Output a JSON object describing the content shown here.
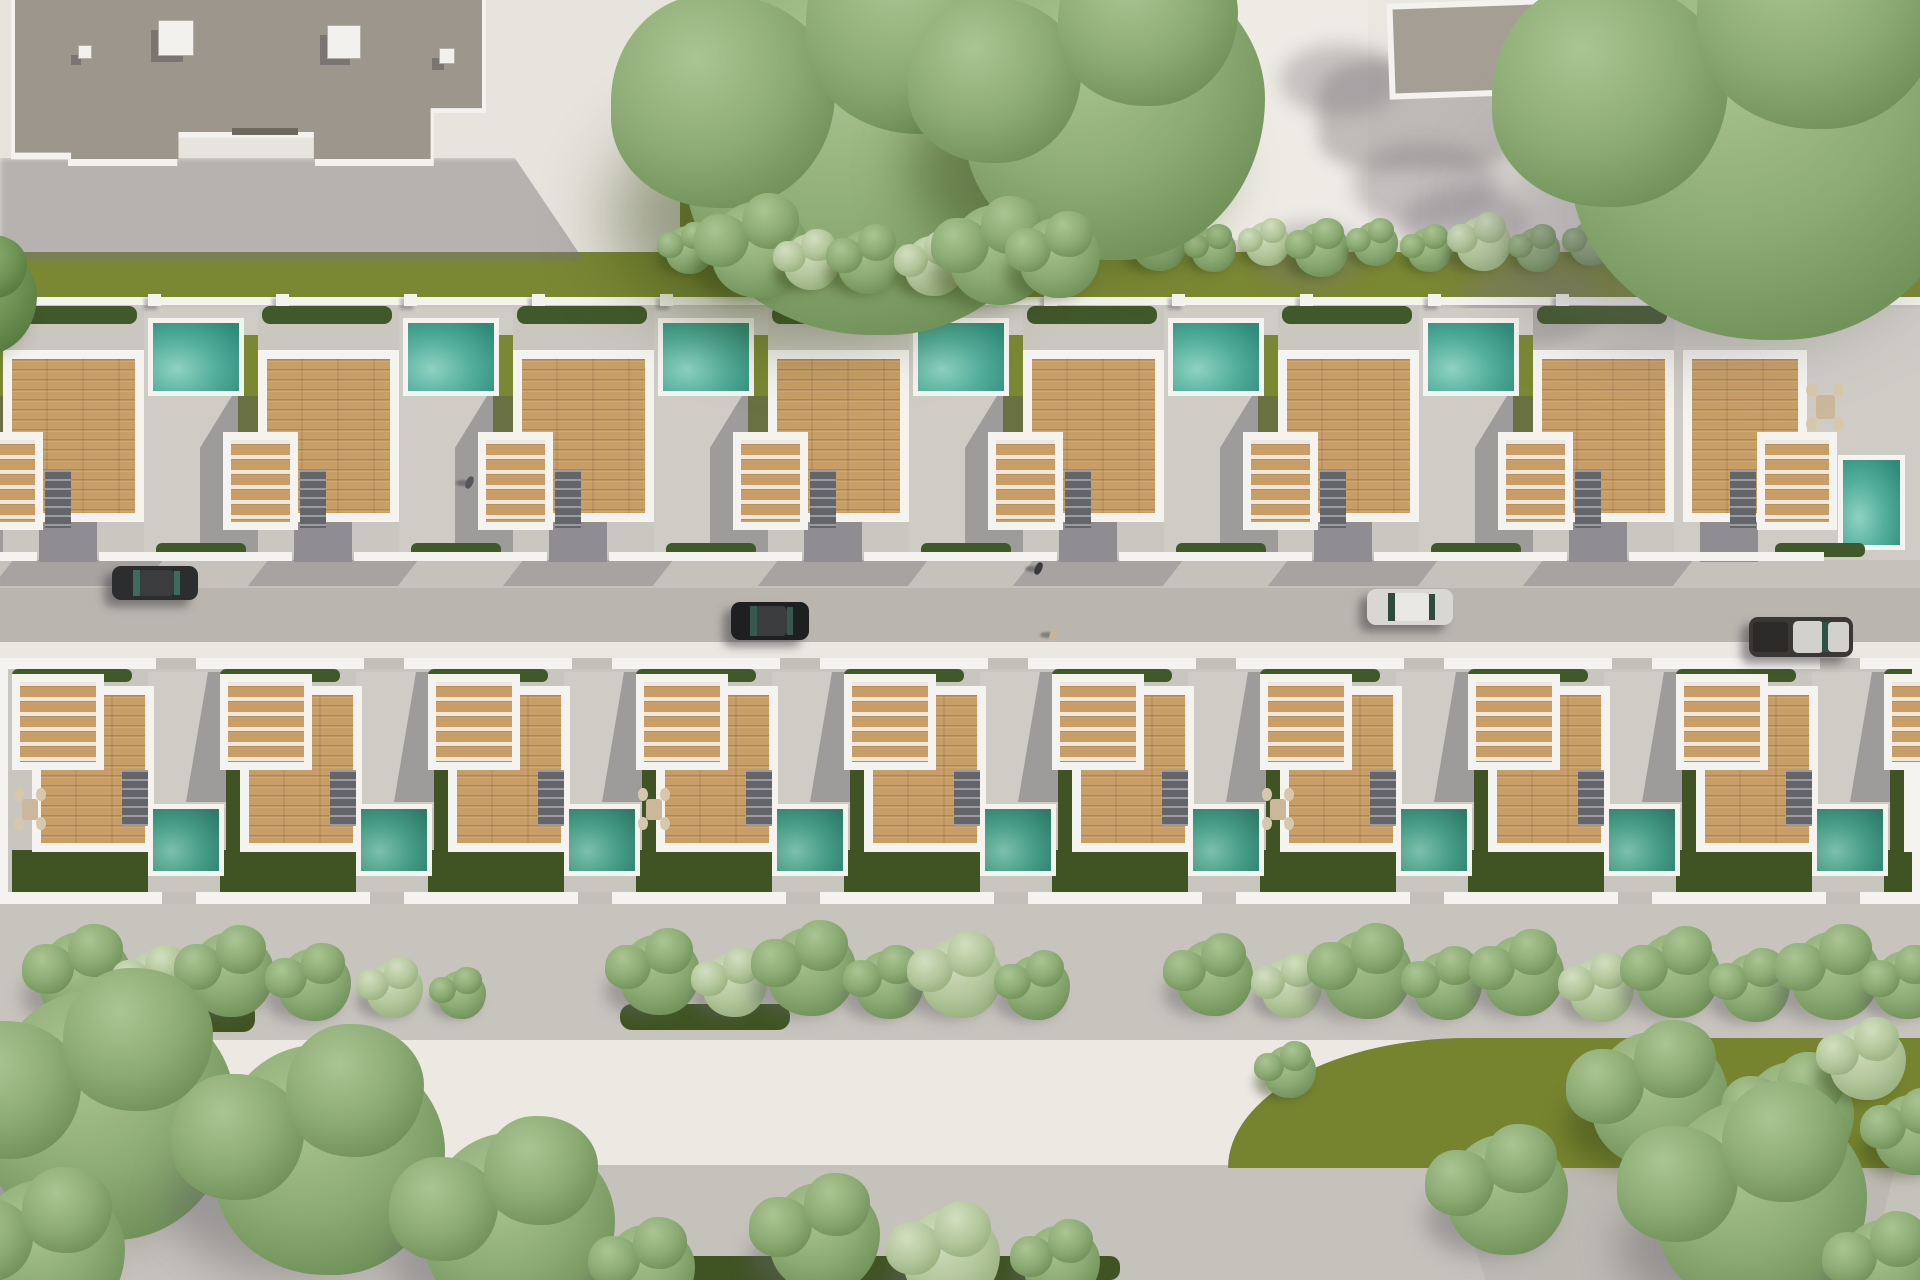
{
  "meta": {
    "scene": "aerial-3d-render-residential-development",
    "summary": {
      "upper_row_villas": 8,
      "lower_row_villas": 9,
      "pools_visible": 16,
      "cars": 4,
      "pedestrians": 3
    }
  },
  "palette": {
    "base": "#d9d5cf",
    "pavement": "#e7e3dd",
    "plaza": "#eae6e0",
    "path": "#eeebe5",
    "roof": "#9d968c",
    "roof_edge": "#f4f2ee",
    "white": "#f5f3ef",
    "grass": "#7a8733",
    "garden": "#3f5422",
    "hedge": "#41582a",
    "concrete": "#cfcbc5",
    "row_base_u": "#cac6c0",
    "row_base_l": "#c9c5bf",
    "sidewalk": "#c6c2bb",
    "asphalt": "#bab6af",
    "curb": "#ebe8e2",
    "promenade": "#c7c3bd",
    "road_white": "#ece9e3",
    "bottom_pav": "#c5c1bb",
    "road_gray": "#bcb8b2",
    "wood": "#c89e66",
    "stair": "#64656b",
    "drive": "#8f8d91",
    "pool_upper": [
      "#8fd2c2",
      "#53ae9c",
      "#2f8a79"
    ],
    "pool_lower": [
      "#7cc0ab",
      "#489e88",
      "#2e7b68"
    ],
    "tones": {
      "sage": [
        "#aac592",
        "#8cab74",
        "#5d7f46"
      ],
      "pale": [
        "#d2dfc0",
        "#b4c79c",
        "#86a06b"
      ],
      "dark": [
        "#8fb273",
        "#6f9455",
        "#47682f"
      ]
    },
    "shadow_ground": "rgba(122,117,121,0.45)",
    "shadow_grass": "rgba(55,70,25,0.45)",
    "shadow_build": "rgba(80,80,88,0.38)"
  },
  "bands": [
    {
      "n": "pavement-top-left",
      "x": 0,
      "y": 0,
      "w": 735,
      "h": 262,
      "c": "#e7e3dd"
    },
    {
      "n": "grass-top-mid",
      "x": 680,
      "y": 0,
      "w": 520,
      "h": 262,
      "c": "#7a8733"
    },
    {
      "n": "path-top",
      "x": 1196,
      "y": 0,
      "w": 176,
      "h": 240,
      "c": "#eeebe5"
    },
    {
      "n": "plaza-top-right",
      "x": 1368,
      "y": 0,
      "w": 552,
      "h": 240,
      "c": "#eae6e0"
    },
    {
      "n": "grass-band",
      "x": 0,
      "y": 252,
      "w": 1920,
      "h": 56,
      "c": "#7a8733"
    },
    {
      "n": "upper-row-ground",
      "x": 0,
      "y": 305,
      "w": 1920,
      "h": 255,
      "c": "#cac6c0"
    },
    {
      "n": "sidewalk-upper",
      "x": 0,
      "y": 556,
      "w": 1920,
      "h": 36,
      "c": "#c6c2bb"
    },
    {
      "n": "street-asphalt",
      "x": 0,
      "y": 588,
      "w": 1920,
      "h": 56,
      "c": "#bab6af"
    },
    {
      "n": "street-curb",
      "x": 0,
      "y": 642,
      "w": 1920,
      "h": 16,
      "c": "#ebe8e2"
    },
    {
      "n": "lower-row-ground",
      "x": 0,
      "y": 658,
      "w": 1920,
      "h": 246,
      "c": "#c9c5bf"
    },
    {
      "n": "promenade",
      "x": 0,
      "y": 903,
      "w": 1920,
      "h": 140,
      "c": "#c7c3bd"
    },
    {
      "n": "road-white",
      "x": 0,
      "y": 1040,
      "w": 1920,
      "h": 128,
      "c": "#ece9e3"
    },
    {
      "n": "pavement-bottom",
      "x": 0,
      "y": 1165,
      "w": 1920,
      "h": 115,
      "c": "#c5c1bb"
    }
  ],
  "building": {
    "x": 15,
    "y": 0,
    "w": 467,
    "h": 162,
    "clip": "polygon(0 0,100% 0,100% 68%,89% 68%,89% 100%,64% 100%,64% 83%,35% 83%,35% 100%,12% 100%,12% 96%,0 96%)",
    "vents": [
      [
        63,
        45,
        14
      ],
      [
        143,
        20,
        36
      ],
      [
        312,
        25,
        34
      ],
      [
        424,
        48,
        16
      ]
    ],
    "vent_line": [
      217,
      128,
      66,
      7
    ],
    "ground_shadow": {
      "x": 0,
      "y": 158,
      "w": 585,
      "h": 104,
      "clip": "polygon(0 0,88% 0,100% 100%,0 100%)"
    }
  },
  "shed_top_right": {
    "x": 1388,
    "y": 0,
    "w": 212,
    "h": 96,
    "rot": -2
  },
  "boundary_wall": {
    "y": 297,
    "h": 8,
    "post_step": 128
  },
  "upper_row": {
    "units": [
      {
        "x": -111
      },
      {
        "x": 144,
        "pool": 1
      },
      {
        "x": 399,
        "pool": 1
      },
      {
        "x": 654,
        "pool": 1
      },
      {
        "x": 909,
        "pool": 1
      },
      {
        "x": 1164,
        "pool": 1
      },
      {
        "x": 1419,
        "pool": 1
      },
      {
        "x": 1674,
        "variant": "end"
      }
    ],
    "end_unit": {
      "deck": [
        1683,
        350,
        124,
        172
      ],
      "terrace": [
        1757,
        432,
        80,
        98
      ],
      "stairs": [
        1730,
        470,
        26,
        58
      ],
      "vpool": [
        1838,
        455,
        67,
        95
      ],
      "table": [
        1806,
        383,
        38,
        48
      ],
      "drive": [
        1700,
        522,
        58,
        40
      ],
      "hedge": [
        1775,
        543,
        90,
        14
      ]
    }
  },
  "lower_row": {
    "units": [
      {
        "x": 4,
        "table": 1
      },
      {
        "x": 212
      },
      {
        "x": 420
      },
      {
        "x": 628,
        "table": 1
      },
      {
        "x": 836
      },
      {
        "x": 1044
      },
      {
        "x": 1252,
        "table": 1
      },
      {
        "x": 1460
      },
      {
        "x": 1668
      },
      {
        "x": 1876
      }
    ]
  },
  "trees": {
    "top_grass": [
      [
        880,
        140,
        195,
        "sage"
      ],
      [
        1115,
        110,
        150,
        "sage"
      ],
      [
        690,
        250,
        24,
        "sage"
      ],
      [
        760,
        250,
        48,
        "sage"
      ],
      [
        812,
        262,
        28,
        "pale"
      ],
      [
        870,
        262,
        32,
        "sage"
      ],
      [
        935,
        266,
        30,
        "pale"
      ],
      [
        1000,
        255,
        50,
        "sage"
      ],
      [
        1060,
        258,
        40,
        "sage"
      ]
    ],
    "plaza": [
      [
        1775,
        135,
        205,
        "sage"
      ]
    ],
    "hedgerow": {
      "from": 1160,
      "to": 1915,
      "step": 54,
      "y": 244,
      "r": 22
    },
    "promenade": [
      [
        85,
        978,
        46,
        "sage"
      ],
      [
        158,
        985,
        34,
        "pale"
      ],
      [
        232,
        975,
        42,
        "sage"
      ],
      [
        315,
        985,
        36,
        "sage"
      ],
      [
        395,
        990,
        28,
        "pale"
      ],
      [
        462,
        995,
        24,
        "sage"
      ],
      [
        660,
        975,
        40,
        "sage"
      ],
      [
        735,
        985,
        32,
        "pale"
      ],
      [
        812,
        972,
        44,
        "sage"
      ],
      [
        890,
        985,
        34,
        "sage"
      ],
      [
        962,
        978,
        40,
        "pale"
      ],
      [
        1038,
        988,
        32,
        "sage"
      ],
      [
        1215,
        978,
        38,
        "sage"
      ],
      [
        1292,
        988,
        30,
        "pale"
      ],
      [
        1368,
        975,
        44,
        "sage"
      ],
      [
        1448,
        986,
        34,
        "sage"
      ],
      [
        1524,
        976,
        40,
        "sage"
      ],
      [
        1602,
        990,
        32,
        "pale"
      ],
      [
        1678,
        976,
        42,
        "sage"
      ],
      [
        1756,
        988,
        34,
        "sage"
      ],
      [
        1836,
        976,
        44,
        "sage"
      ],
      [
        1908,
        985,
        34,
        "sage"
      ]
    ],
    "wedge": [
      [
        1290,
        1072,
        26,
        "sage"
      ],
      [
        1660,
        1100,
        68,
        "sage"
      ],
      [
        1798,
        1118,
        56,
        "sage"
      ],
      [
        1868,
        1062,
        38,
        "pale"
      ],
      [
        1915,
        1135,
        40,
        "sage"
      ]
    ],
    "bottom_left": [
      [
        110,
        1115,
        125,
        "sage"
      ],
      [
        330,
        1160,
        115,
        "sage"
      ],
      [
        520,
        1228,
        95,
        "sage"
      ],
      [
        50,
        1255,
        75,
        "sage"
      ],
      [
        650,
        1270,
        45,
        "sage"
      ]
    ],
    "bottom_mid": [
      [
        825,
        1238,
        55,
        "sage"
      ],
      [
        952,
        1258,
        48,
        "pale"
      ],
      [
        1062,
        1264,
        38,
        "sage"
      ]
    ],
    "bottom_right": [
      [
        1508,
        1195,
        60,
        "sage"
      ],
      [
        1762,
        1205,
        105,
        "sage"
      ],
      [
        1888,
        1268,
        48,
        "sage"
      ]
    ],
    "left_edge": [
      [
        -18,
        300,
        55,
        "dark"
      ]
    ]
  },
  "green_wedge": {
    "x": 1228,
    "y": 1038,
    "w": 692,
    "h": 130,
    "c": "#76832f",
    "radius": "240px 0 0 0 / 130px 0 0 0"
  },
  "bottom_right_road": {
    "x": 1430,
    "y": 1168,
    "w": 465,
    "h": 112,
    "clip": "polygon(4% 0,100% 0,94% 100%,12% 100%)"
  },
  "bottom_green_strip": {
    "x": 440,
    "y": 1256,
    "w": 680,
    "h": 24
  },
  "hedge_strips_promenade": [
    [
      55,
      1002,
      200,
      30
    ],
    [
      620,
      1004,
      170,
      26
    ]
  ],
  "plaza_shadow_blobs": [
    [
      1340,
      80,
      60
    ],
    [
      1425,
      185,
      72
    ],
    [
      1310,
      255,
      55
    ],
    [
      1530,
      305,
      70
    ],
    [
      1620,
      390,
      60
    ],
    [
      1465,
      225,
      65
    ]
  ],
  "cars": [
    {
      "x": 112,
      "y": 566,
      "w": 86,
      "h": 34,
      "body": "#2c2d2f",
      "glass": "#3f6a5e",
      "type": "sedan"
    },
    {
      "x": 731,
      "y": 602,
      "w": 78,
      "h": 38,
      "body": "#1e1f21",
      "glass": "#37584e",
      "type": "suv"
    },
    {
      "x": 1367,
      "y": 589,
      "w": 86,
      "h": 36,
      "body": "#d9d7d3",
      "glass": "#2f4a3e",
      "type": "sedan"
    },
    {
      "x": 1749,
      "y": 617,
      "w": 104,
      "h": 40,
      "body": "#3a3734",
      "glass": "#2e5148",
      "cab": "#d3d1cd",
      "type": "pickup"
    }
  ],
  "pedestrians": [
    {
      "x": 466,
      "y": 476,
      "c": "#55565a"
    },
    {
      "x": 1035,
      "y": 562,
      "c": "#3a3a3c"
    },
    {
      "x": 1050,
      "y": 628,
      "c": "#c9b49a"
    }
  ]
}
